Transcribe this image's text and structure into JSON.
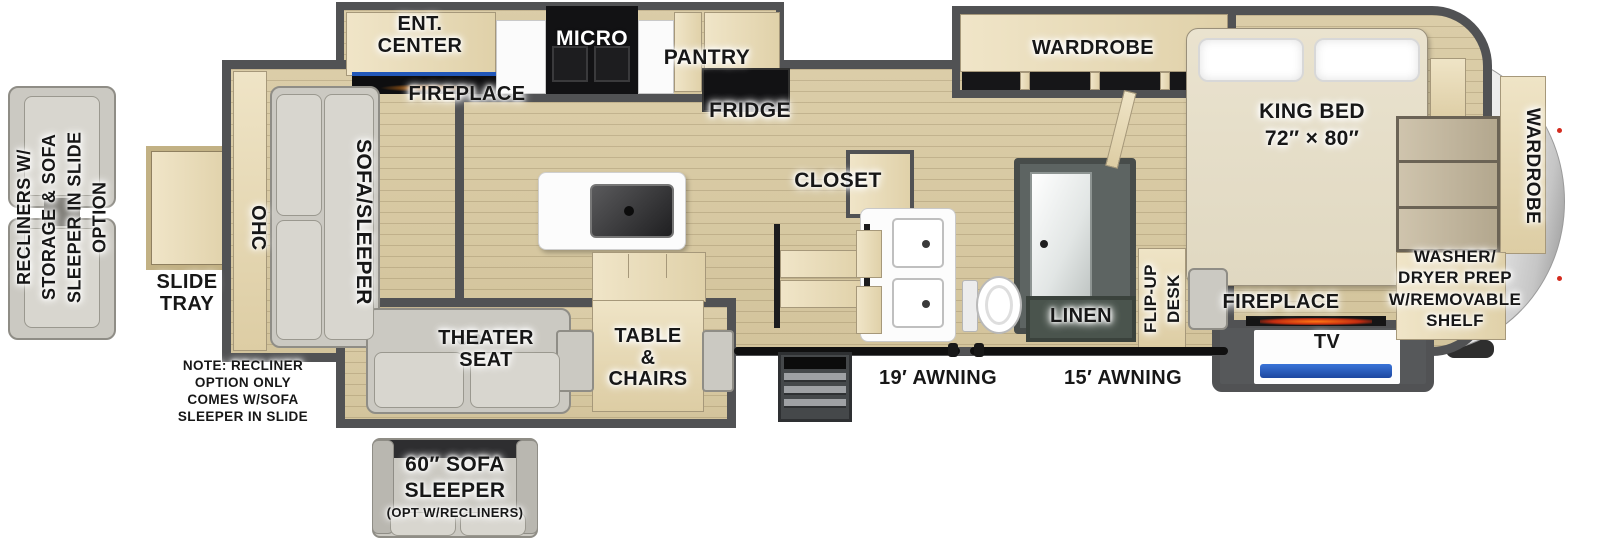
{
  "floorplan": {
    "left_option": {
      "recliners_label": "RECLINERS W/\nSTORAGE & SOFA\nSLEEPER IN SLIDE\nOPTION"
    },
    "slide_tray": {
      "label": "SLIDE\nTRAY"
    },
    "living": {
      "ohc": "OHC",
      "sofa_sleeper": "SOFA/SLEEPER",
      "ent_center": "ENT.\nCENTER",
      "fireplace": "FIREPLACE",
      "theater_seat": "THEATER\nSEAT",
      "table_chairs": "TABLE\n&\nCHAIRS",
      "note": "NOTE: RECLINER\nOPTION ONLY\nCOMES W/SOFA\nSLEEPER IN SLIDE"
    },
    "kitchen": {
      "micro": "MICRO",
      "pantry": "PANTRY",
      "fridge": "FRIDGE",
      "closet": "CLOSET"
    },
    "bathroom": {
      "linen": "LINEN"
    },
    "bedroom": {
      "wardrobe": "WARDROBE",
      "king_bed": "KING BED\n72″ × 80″",
      "flip_up_desk": "FLIP-UP\nDESK",
      "fireplace": "FIREPLACE",
      "tv": "TV"
    },
    "front_cap": {
      "wardrobe": "WARDROBE",
      "washer_dryer": "WASHER/\nDRYER PREP\nW/REMOVABLE\nSHELF"
    },
    "exterior": {
      "awning_19": "19′ AWNING",
      "awning_15": "15′ AWNING"
    },
    "bottom_option": {
      "title": "60″ SOFA\nSLEEPER",
      "subtitle": "(OPT W/RECLINERS)"
    },
    "colors": {
      "wall": "#515254",
      "floor": "#d7c8a2",
      "cabinet_wood": "#e9dcba",
      "fabric_gray": "#cbc9c2",
      "accent_blue": "#2d62c4",
      "accent_orange": "#e0561a",
      "linen_green": "#4a544d",
      "cap_silver": "#c9c9c9"
    }
  }
}
